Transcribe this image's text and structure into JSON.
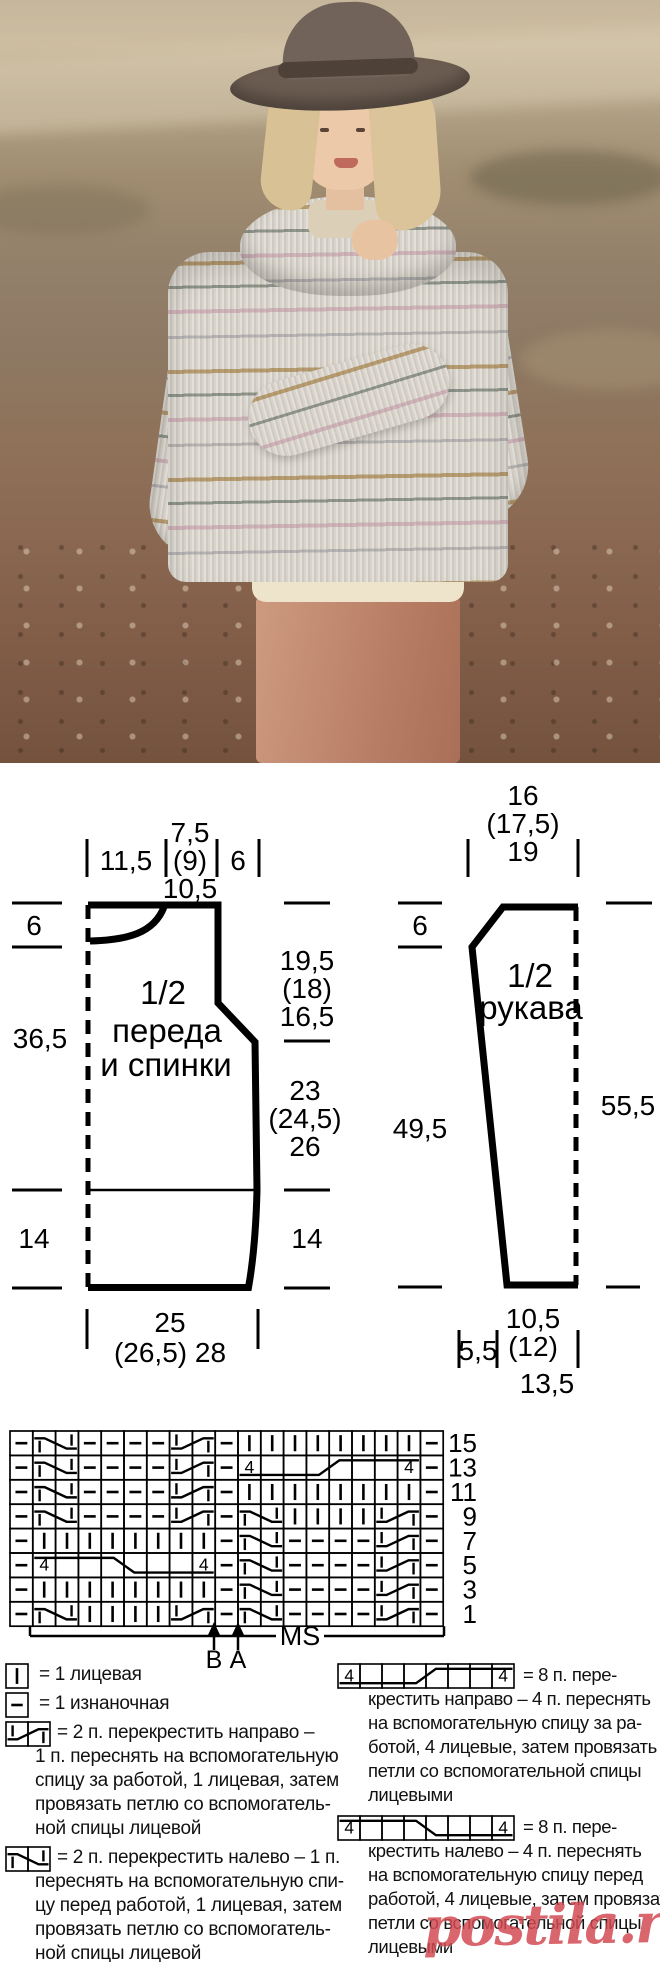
{
  "photo": {
    "description": "Модель в широкополой шляпе и меланжевом полосатом пуловере с воротником-шалью на фоне сухих холмов"
  },
  "schematic": {
    "body": {
      "title": [
        "1/2",
        "переда",
        "и спинки"
      ],
      "top": {
        "left": "11,5",
        "neck": [
          "7,5",
          "(9)",
          "10,5"
        ],
        "right": "6"
      },
      "left": {
        "neck": "6",
        "length": "36,5",
        "rib": "14"
      },
      "right": {
        "armhole": [
          "19,5",
          "(18)",
          "16,5"
        ],
        "side": [
          "23",
          "(24,5)",
          "26"
        ],
        "rib": "14"
      },
      "bottom": [
        "25",
        "(26,5) 28"
      ]
    },
    "sleeve": {
      "title": [
        "1/2",
        "рукава"
      ],
      "top": [
        "16",
        "(17,5)",
        "19"
      ],
      "left": {
        "cap": "6",
        "length": "49,5"
      },
      "right": {
        "length": "55,5"
      },
      "bottom": {
        "offset": "5,5",
        "width": [
          "10,5",
          "(12)",
          "13,5"
        ]
      }
    }
  },
  "chart": {
    "row_numbers": [
      "15",
      "13",
      "11",
      "9",
      "7",
      "5",
      "3",
      "1"
    ],
    "rows": [
      [
        "p",
        "lc2",
        "p",
        "p",
        "p",
        "p",
        "rc2",
        "p",
        "k",
        "k",
        "k",
        "k",
        "k",
        "k",
        "k",
        "k",
        "p"
      ],
      [
        "p",
        "lc2",
        "p",
        "p",
        "p",
        "p",
        "rc2",
        "p",
        "rc8",
        "p"
      ],
      [
        "p",
        "lc2",
        "p",
        "p",
        "p",
        "p",
        "rc2",
        "p",
        "k",
        "k",
        "k",
        "k",
        "k",
        "k",
        "k",
        "k",
        "p"
      ],
      [
        "p",
        "lc2",
        "p",
        "p",
        "p",
        "p",
        "rc2",
        "p",
        "lc2",
        "k",
        "k",
        "k",
        "k",
        "rc2",
        "p"
      ],
      [
        "p",
        "k",
        "k",
        "k",
        "k",
        "k",
        "k",
        "k",
        "k",
        "p",
        "lc2",
        "p",
        "p",
        "p",
        "p",
        "rc2",
        "p"
      ],
      [
        "p",
        "lc8",
        "p",
        "lc2",
        "p",
        "p",
        "p",
        "p",
        "rc2",
        "p"
      ],
      [
        "p",
        "k",
        "k",
        "k",
        "k",
        "k",
        "k",
        "k",
        "k",
        "p",
        "lc2",
        "p",
        "p",
        "p",
        "p",
        "rc2",
        "p"
      ],
      [
        "p",
        "lc2",
        "k",
        "k",
        "k",
        "k",
        "rc2",
        "p",
        "lc2",
        "p",
        "p",
        "p",
        "p",
        "rc2",
        "p"
      ]
    ],
    "cable_number": "4",
    "markers": {
      "b": "B",
      "a": "A",
      "ms": "MS"
    }
  },
  "legend": {
    "left": [
      {
        "symbol": "k1",
        "text_lines": [
          "= 1 лицевая"
        ]
      },
      {
        "symbol": "p1",
        "text_lines": [
          "= 1 изнаночная"
        ]
      },
      {
        "symbol": "rc2",
        "text_lines": [
          "= 2 п. перекрестить направо –",
          "1 п. переснять на вспомогательную",
          "спицу за работой, 1 лицевая, затем",
          "провязать петлю со вспомогатель-",
          "ной спицы лицевой"
        ]
      },
      {
        "symbol": "lc2",
        "text_lines": [
          "= 2 п. перекрестить налево – 1 п.",
          "переснять на вспомогательную спи-",
          "цу перед работой, 1 лицевая, затем",
          "провязать петлю со вспомогатель-",
          "ной спицы лицевой"
        ]
      }
    ],
    "right": [
      {
        "symbol": "rc8",
        "text_lines": [
          "= 8 п. пере-",
          "крестить направо – 4 п. переснять",
          "на вспомогательную спицу за ра-",
          "ботой, 4 лицевые, затем провязать",
          "петли со вспомогательной спицы",
          "лицевыми"
        ]
      },
      {
        "symbol": "lc8",
        "text_lines": [
          "= 8 п. пере-",
          "крестить налево – 4 п. переснять",
          "на вспомогательную спицу перед",
          "работой, 4 лицевые, затем провязать",
          "петли со вспомогательной спицы",
          "лицевыми"
        ]
      }
    ]
  },
  "watermark": {
    "text": "postila.ru",
    "color": "#cf3e49"
  }
}
